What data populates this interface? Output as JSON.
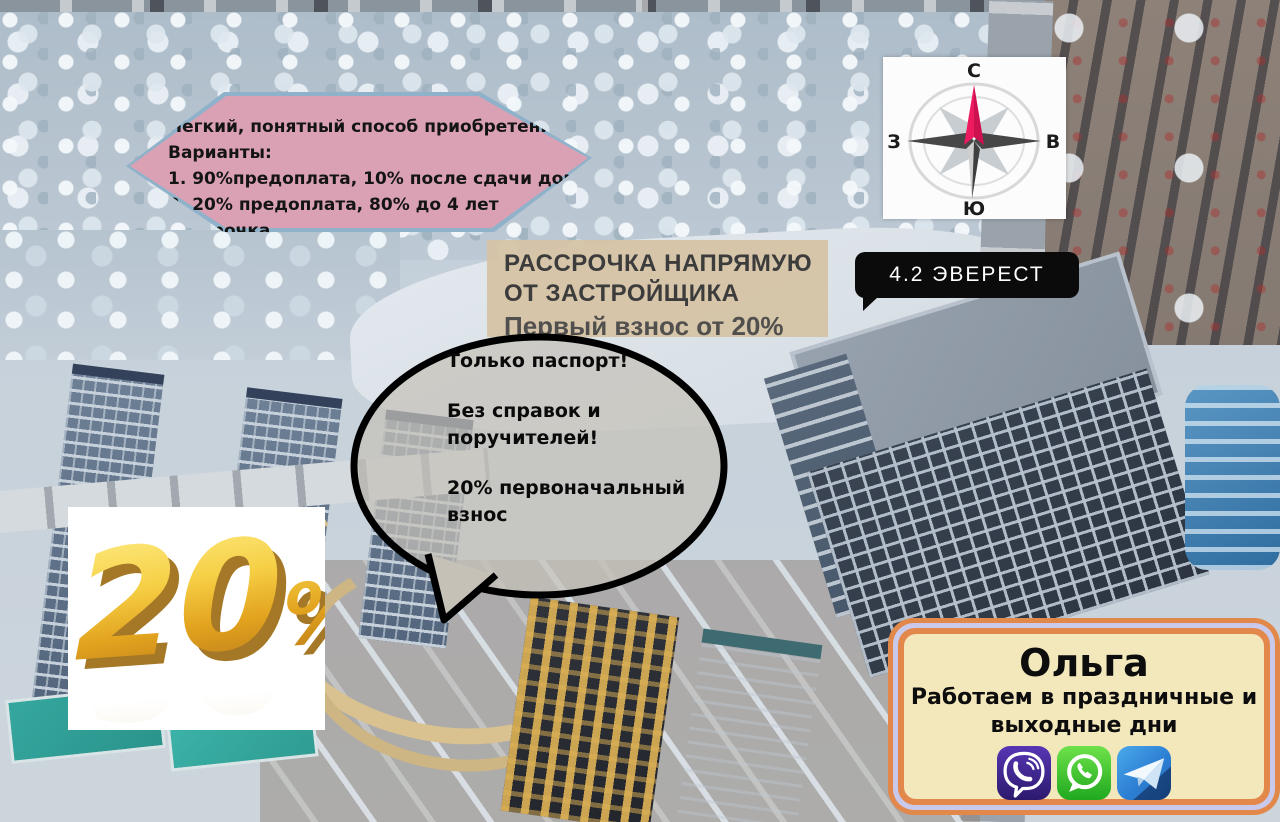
{
  "poster": {
    "offer_banner": {
      "title": "Легкий, понятный способ приобретения:",
      "subtitle": "Варианты:",
      "options": [
        "1. 90%предоплата, 10% после сдачи дома",
        "2. 20% предоплата, 80% до 4 лет рассрочка",
        "3. Потребительский кредит"
      ],
      "fill_color": "#e79eb2",
      "border_color": "#8fb2ca"
    },
    "compass": {
      "north_label": "С",
      "east_label": "В",
      "south_label": "Ю",
      "west_label": "З",
      "needle_color": "#ed1a5f"
    },
    "building_label": {
      "text": "4.2 ЭВЕРЕСТ",
      "bg_color": "#0b0b0b"
    },
    "installment_panel": {
      "heading_line1": "РАССРОЧКА НАПРЯМУЮ",
      "heading_line2": "ОТ ЗАСТРОЙЩИКА",
      "subheading": "Первый взнос от 20%",
      "bg_color": "#d5c3a5"
    },
    "speech_bubble": {
      "line1": "Только паспорт!",
      "line2": "Без справок и",
      "line3": "поручителей!",
      "line4": "20% первоначальный",
      "line5": "взнос"
    },
    "discount_badge": {
      "value": "20",
      "unit": "%",
      "gold_color": "#f0c63e"
    },
    "contact_card": {
      "name": "Ольга",
      "schedule_line1": "Работаем в праздничные и",
      "schedule_line2": "выходные дни",
      "border_color": "#e2884a",
      "inner_ring_color": "#c9c9ec",
      "bg_color": "#f3e7bc",
      "messengers": [
        {
          "name": "viber",
          "color": "#4c2e9e"
        },
        {
          "name": "whatsapp",
          "color": "#35c522"
        },
        {
          "name": "telegram",
          "color": "#2b7cd3"
        }
      ]
    }
  }
}
